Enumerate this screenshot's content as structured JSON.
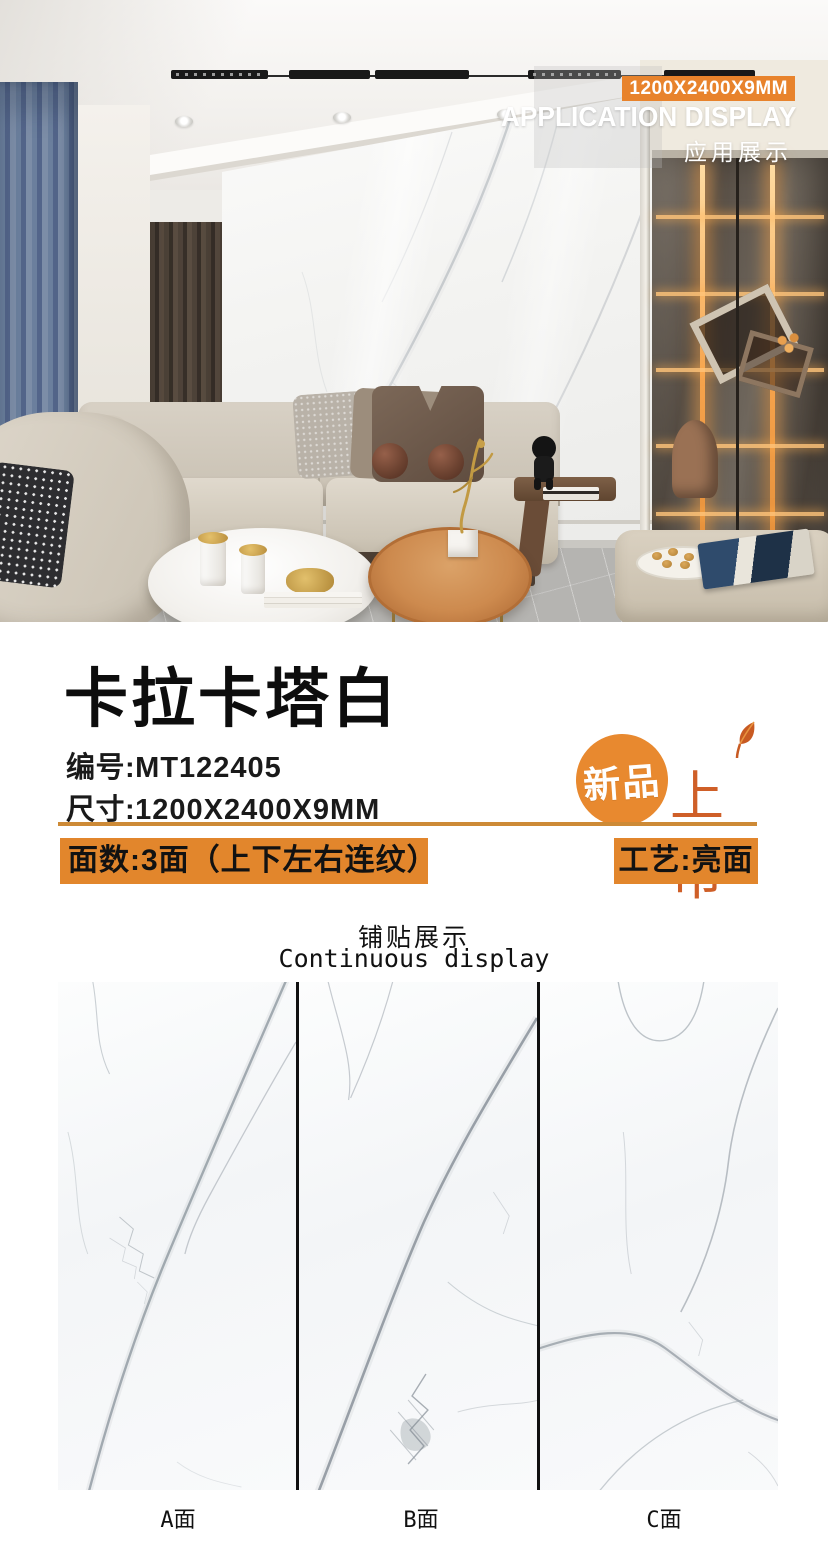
{
  "hero": {
    "size_badge": "1200X2400X9MM",
    "app_display_en": "APPLICATION DISPLAY",
    "app_display_zh": "应用展示"
  },
  "product": {
    "name": "卡拉卡塔白",
    "code_label": "编号:",
    "code_value": "MT122405",
    "size_label": "尺寸:",
    "size_value": "1200X2400X9MM",
    "faces_text": "面数:3面（上下左右连纹）",
    "finish_text": "工艺:亮面",
    "new_badge_circle": "新品",
    "new_badge_side": "上市"
  },
  "paving": {
    "title_zh": "铺贴展示",
    "title_en": "Continuous display",
    "panel_labels": [
      "A面",
      "B面",
      "C面"
    ]
  },
  "colors": {
    "bar_orange": "#e2862c",
    "badge_orange": "#e8832c",
    "new_badge_orange": "#e8892f",
    "new_badge_text_orange": "#cf5f28",
    "underline_tan": "#cd8a36",
    "panel_divider_black": "#101010",
    "vein_gray": "#8f98a0"
  }
}
